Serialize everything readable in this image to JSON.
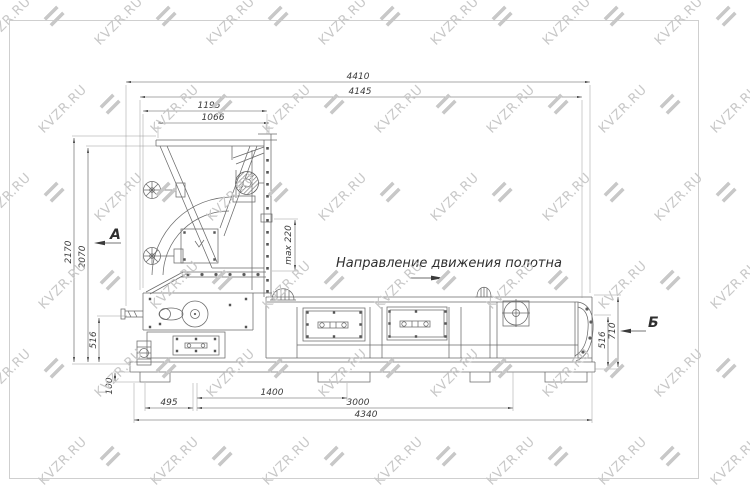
{
  "watermark": {
    "text": "KVZR.RU",
    "color": "#c8c8c8"
  },
  "annotation": {
    "direction": "Направление движения полотна"
  },
  "sections": {
    "a": "А",
    "b": "Б"
  },
  "dimensions": {
    "d4410": "4410",
    "d4145": "4145",
    "d1195": "1195",
    "d1066": "1066",
    "d2170": "2170",
    "d2070": "2070",
    "d516_left": "516",
    "d100": "100",
    "dmax220": "max 220",
    "d495": "495",
    "d1400": "1400",
    "d3000": "3000",
    "d4340": "4340",
    "d516_right": "516",
    "d710": "710"
  }
}
